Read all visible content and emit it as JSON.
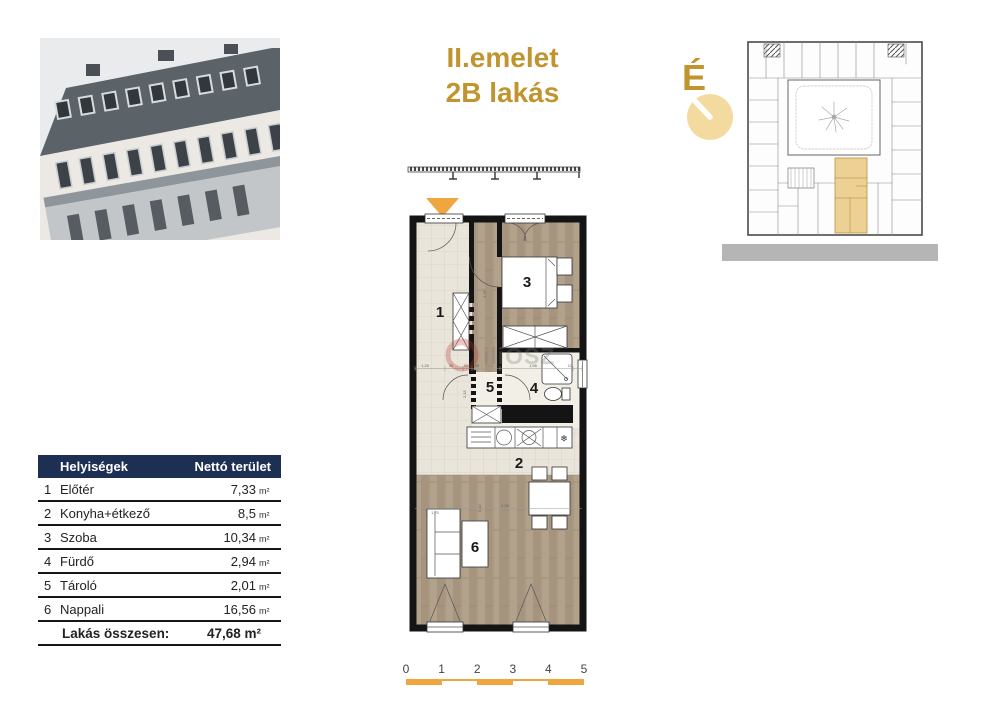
{
  "theme": {
    "gold": "#c0952f",
    "accent": "#f0a63e",
    "navy": "#1d3054",
    "highlight": "#edd093",
    "street": "#b5b5b5",
    "compassCircle": "#f3dba0"
  },
  "title": {
    "line1": "II.emelet",
    "line2": "2B lakás"
  },
  "compass": {
    "label": "É"
  },
  "watermark": {
    "text": "iliOSZ"
  },
  "floorplan": {
    "rooms": {
      "r1": "1",
      "r2": "2",
      "r3": "3",
      "r4": "4",
      "r5": "5",
      "r6": "6"
    },
    "fridge_symbol": "❄",
    "dims": {
      "a": "1,26",
      "b": "30",
      "c": "50",
      "d": "30",
      "e": "1,98",
      "f": "10",
      "v1": "2,15",
      "v2": "3,45",
      "v3": "5,42",
      "h1": "4,35",
      "h2": "1,70"
    }
  },
  "table": {
    "col1": "Helyiségek",
    "col2": "Nettó terület",
    "rows": [
      {
        "num": "1",
        "name": "Előtér",
        "value": "7,33",
        "unit": "m²"
      },
      {
        "num": "2",
        "name": "Konyha+étkező",
        "value": "8,5",
        "unit": "m²"
      },
      {
        "num": "3",
        "name": "Szoba",
        "value": "10,34",
        "unit": "m²"
      },
      {
        "num": "4",
        "name": "Fürdő",
        "value": "2,94",
        "unit": "m²"
      },
      {
        "num": "5",
        "name": "Tároló",
        "value": "2,01",
        "unit": "m²"
      },
      {
        "num": "6",
        "name": "Nappali",
        "value": "16,56",
        "unit": "m²"
      }
    ],
    "total_label": "Lakás összesen:",
    "total_value": "47,68 m²"
  },
  "scalebar": {
    "ticks": [
      "0",
      "1",
      "2",
      "3",
      "4",
      "5"
    ]
  }
}
